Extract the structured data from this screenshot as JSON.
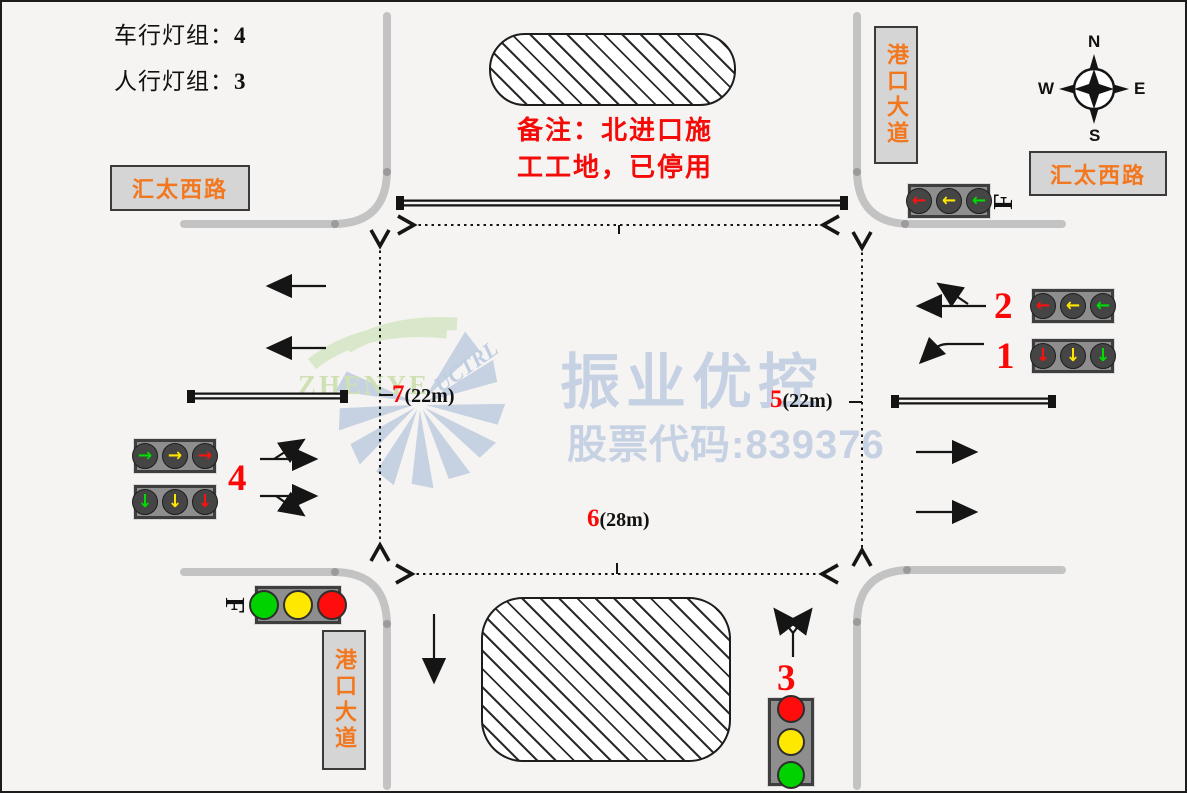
{
  "palette": {
    "background": "#f5f4f2",
    "road_gray": "#c3c3c3",
    "note_red": "#f40b08",
    "number_red": "#fb0706",
    "road_label_orange": "#f2771e",
    "road_label_box": "#d5d5d5",
    "watermark_blue": "#c6d2e3",
    "watermark_green": "#cfe0b4",
    "signal_red": "#ff0d0d",
    "signal_yellow": "#ffe800",
    "signal_green": "#00d200"
  },
  "header": {
    "vehicle_label": "车行灯组：",
    "vehicle_value": "4",
    "ped_label": "人行灯组：",
    "ped_value": "3"
  },
  "note": {
    "line1": "备注：北进口施",
    "line2": "工工地，已停用"
  },
  "road_labels": {
    "west": "汇太西路",
    "east": "汇太西路",
    "north": "港口大道",
    "south": "港口大道"
  },
  "compass": {
    "n": "N",
    "e": "E",
    "s": "S",
    "w": "W"
  },
  "watermark": {
    "brand": "振业优控",
    "stock_line": "股票代码:839376",
    "logo_name": "ZHENYE",
    "logo_sub": "UCTRL"
  },
  "dimensions": {
    "west_num": "7",
    "west_len": "(22m)",
    "east_num": "5",
    "east_len": "(22m)",
    "south_num": "6",
    "south_len": "(28m)"
  },
  "signals": {
    "ne_lenses": [
      "←",
      "←",
      "←"
    ],
    "group2": {
      "number": "2",
      "lenses": [
        "←",
        "←",
        "←"
      ]
    },
    "group1": {
      "number": "1",
      "lenses": [
        "↓",
        "↓",
        "↓"
      ]
    },
    "group4": {
      "number": "4",
      "upper_lenses": [
        "→",
        "→",
        "→"
      ],
      "lower_lenses": [
        "↓",
        "↓",
        "↓"
      ]
    },
    "group3": {
      "number": "3"
    },
    "ped_icon": "F"
  }
}
